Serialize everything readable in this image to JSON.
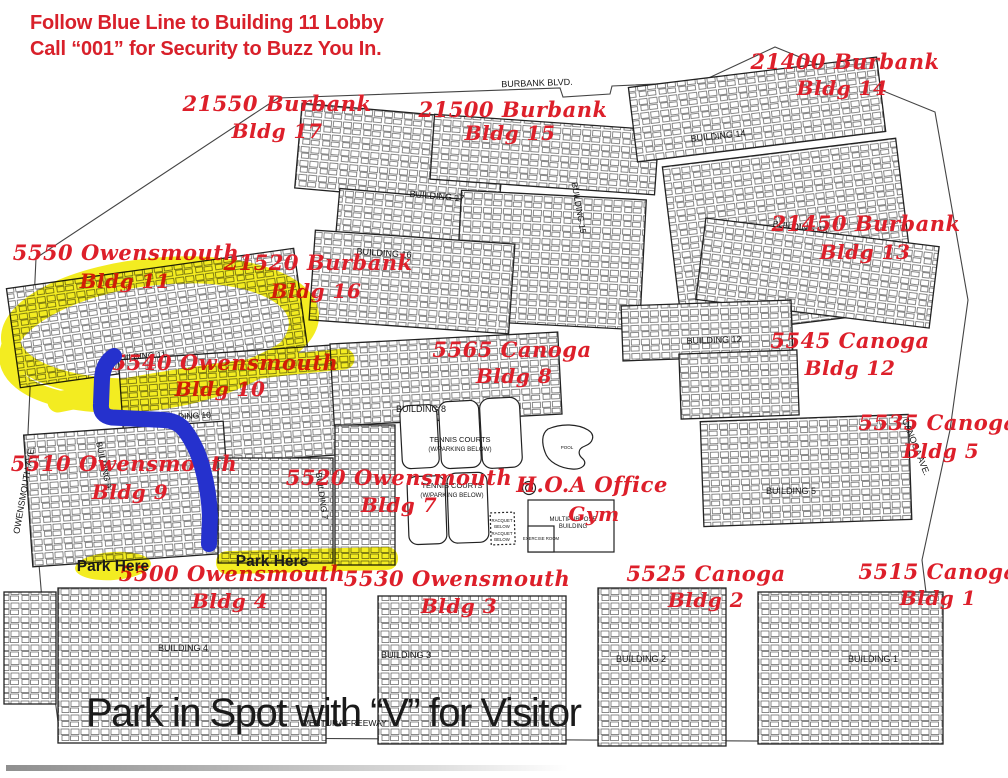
{
  "instructions": {
    "line1": "Follow Blue Line to Building 11 Lobby",
    "line2": "Call “001” for Security to Buzz You In."
  },
  "bottom_note": "Park in Spot with “V” for Visitor",
  "park_here": {
    "left": "Park Here",
    "right": "Park Here"
  },
  "addresses": [
    {
      "street": "21550 Burbank",
      "bldg": "Bldg 17"
    },
    {
      "street": "21500 Burbank",
      "bldg": "Bldg 15"
    },
    {
      "street": "21400 Burbank",
      "bldg": "Bldg 14"
    },
    {
      "street": "21450 Burbank",
      "bldg": "Bldg 13"
    },
    {
      "street": "5550 Owensmouth",
      "bldg": "Bldg 11"
    },
    {
      "street": "21520 Burbank",
      "bldg": "Bldg 16"
    },
    {
      "street": "5565 Canoga",
      "bldg": "Bldg 8"
    },
    {
      "street": "5545 Canoga",
      "bldg": "Bldg 12"
    },
    {
      "street": "5535 Canoga",
      "bldg": "Bldg 5"
    },
    {
      "street": "5540 Owensmouth",
      "bldg": "Bldg 10"
    },
    {
      "street": "5510 Owensmouth",
      "bldg": "Bldg 9"
    },
    {
      "street": "5520 Owensmouth",
      "bldg": "Bldg 7"
    },
    {
      "street": "H.O.A Office",
      "bldg": "Gym"
    },
    {
      "street": "5500 Owensmouth",
      "bldg": "Bldg 4"
    },
    {
      "street": "5530 Owensmouth",
      "bldg": "Bldg 3"
    },
    {
      "street": "5525 Canoga",
      "bldg": "Bldg 2"
    },
    {
      "street": "5515 Canoga",
      "bldg": "Bldg 1"
    }
  ],
  "map": {
    "streets": {
      "burbank": "BURBANK BLVD.",
      "owensmouth": "OWENSMOUTH AVE.",
      "canoga": "CANOGA AVE.",
      "ventura": "VENTURA FREEWAY"
    },
    "buildings": [
      "BUILDING 17",
      "BUILDING 15",
      "BUILDING 14",
      "BUILDING 16",
      "BUILDING 13",
      "BUILDING 12",
      "BUILDING 11",
      "BUILDING 10",
      "BUILDING 9",
      "BUILDING 8",
      "BUILDING 7",
      "BUILDING 5",
      "BUILDING 4",
      "BUILDING 3",
      "BUILDING 2",
      "BUILDING 1"
    ],
    "amenities": {
      "tennis_upper_1": "TENNIS COURTS",
      "tennis_upper_2": "(W/PARKING BELOW)",
      "tennis_lower_1": "TENNIS COURTS",
      "tennis_lower_2": "(W/PARKING BELOW)",
      "racquet_1": "RACQUET",
      "racquet_2": "BELOW",
      "racquet_3": "RACQUET",
      "racquet_4": "BELOW",
      "multipurpose_1": "MULTIPURPOSE",
      "multipurpose_2": "BUILDING",
      "exercise": "EXERCISE ROOM",
      "pool": "POOL"
    }
  },
  "colors": {
    "red": "#dd1f2a",
    "yellow": "#f3eb15",
    "blue": "#2531cd"
  }
}
